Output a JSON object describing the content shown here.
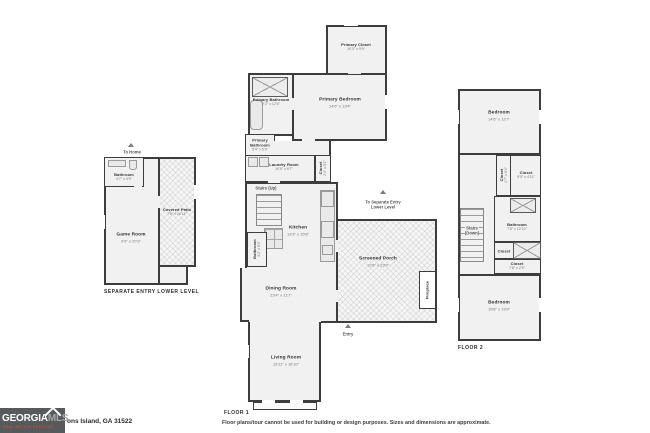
{
  "meta": {
    "floor1_label": "FLOOR 1",
    "floor2_label": "FLOOR 2",
    "lower_level_label": "SEPARATE ENTRY LOWER LEVEL",
    "address": "ons Island, GA 31522",
    "disclaimer": "Floor plans/tour cannot be used for building or design purposes. Sizes and dimensions are approximate."
  },
  "logo": {
    "georgia": "GEORGIA",
    "mls": "MLS",
    "tagline": "REAL ESTATE SERVICES",
    "bg": "#58595b",
    "tagline_color": "#b5534c"
  },
  "colors": {
    "wall": "#3d3d3d",
    "room_fill": "#f1f1f1",
    "hatch_fill": "#f6f6f6"
  },
  "lower_level": {
    "to_home": "To Home",
    "bathroom": {
      "name": "Bathroom",
      "dims": "4'7\" x 4'9\""
    },
    "covered_patio": {
      "name": "Covered Patio",
      "dims": "7'6\" x 26'11\""
    },
    "game_room": {
      "name": "Game Room",
      "dims": "9'9\" x 20'3\""
    }
  },
  "floor1": {
    "primary_closet": {
      "name": "Primary Closet",
      "dims": "10'3\" x 9'9\""
    },
    "primary_bedroom": {
      "name": "Primary Bedroom",
      "dims": "14'6\" x 13'4\""
    },
    "primary_bathroom": {
      "name": "Primary Bathroom",
      "dims": "7'2\" x 12'6\""
    },
    "primary_bathroom_2": {
      "name": "Primary Bathroom",
      "dims": "5'4\" x 5'3\""
    },
    "laundry_room": {
      "name": "Laundry Room",
      "dims": "10'0\" x 6'7\""
    },
    "closet": {
      "name": "Closet",
      "dims": "2'4\" x 5'1\""
    },
    "stairs_up": "Stairs (Up)",
    "kitchen": {
      "name": "Kitchen",
      "dims": "13'3\" x 15'8\""
    },
    "bathroom": {
      "name": "Bathroom",
      "dims": "3'2\" x 8'3\""
    },
    "dining_room": {
      "name": "Dining Room",
      "dims": "23'4\" x 11'7\""
    },
    "living_room": {
      "name": "Living Room",
      "dims": "13'11\" x 16'10\""
    },
    "screened_porch": {
      "name": "Screened Porch",
      "dims": "19'8\" x 23'9\""
    },
    "fireplace": "Fireplace",
    "to_lower_line1": "To Separate Entry",
    "to_lower_line2": "Lower Level",
    "entry": "Entry"
  },
  "floor2": {
    "bedroom_upper": {
      "name": "Bedroom",
      "dims": "14'6\" x 12'7\""
    },
    "closet_tall": {
      "name": "Closet",
      "dims": "2'7\" x 6'4\""
    },
    "closet_mid": {
      "name": "Closet",
      "dims": "9'5\" x 4'11\""
    },
    "stairs_down_line1": "Stairs",
    "stairs_down_line2": "(Down)",
    "bathroom": {
      "name": "Bathroom",
      "dims": "7'8\" x 12'10\""
    },
    "closet_small": "Closet",
    "closet_wide": {
      "name": "Closet",
      "dims": "7'8\" x 2'5\""
    },
    "bedroom_lower": {
      "name": "Bedroom",
      "dims": "15'8\" x 13'9\""
    }
  }
}
